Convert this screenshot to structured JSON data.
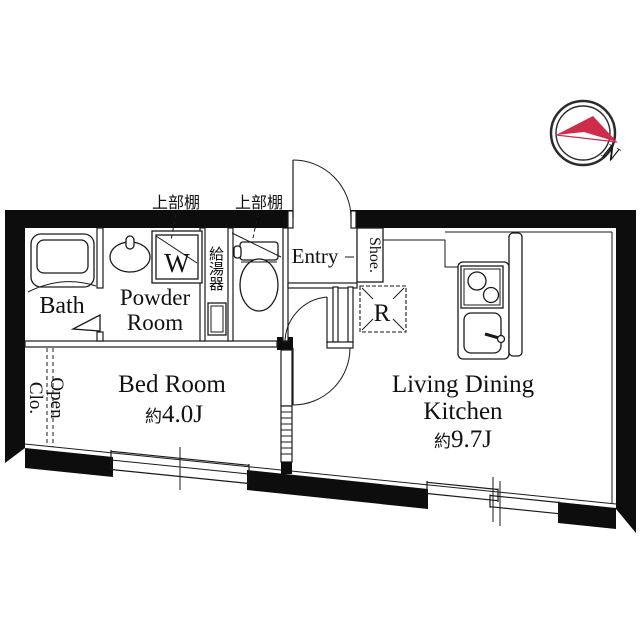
{
  "plan": {
    "rooms": {
      "bath": "Bath",
      "powder_line1": "Powder",
      "powder_line2": "Room",
      "bed_line1": "Bed Room",
      "bed_area_prefix": "約",
      "bed_area": "4.0J",
      "ldk_line1": "Living Dining",
      "ldk_line2": "Kitchen",
      "ldk_area_prefix": "約",
      "ldk_area": "9.7J",
      "entry": "Entry",
      "open_clo_line1": "Open",
      "open_clo_line2": "Clo.",
      "shoe": "Shoe.",
      "washer": "W",
      "fridge": "R",
      "water_heater": "給湯器",
      "shelf_left": "上部棚",
      "shelf_right": "上部棚"
    },
    "compass": {
      "north": "N"
    },
    "colors": {
      "accent": "#cf2b4b",
      "wall": "#0d0d0d"
    }
  }
}
